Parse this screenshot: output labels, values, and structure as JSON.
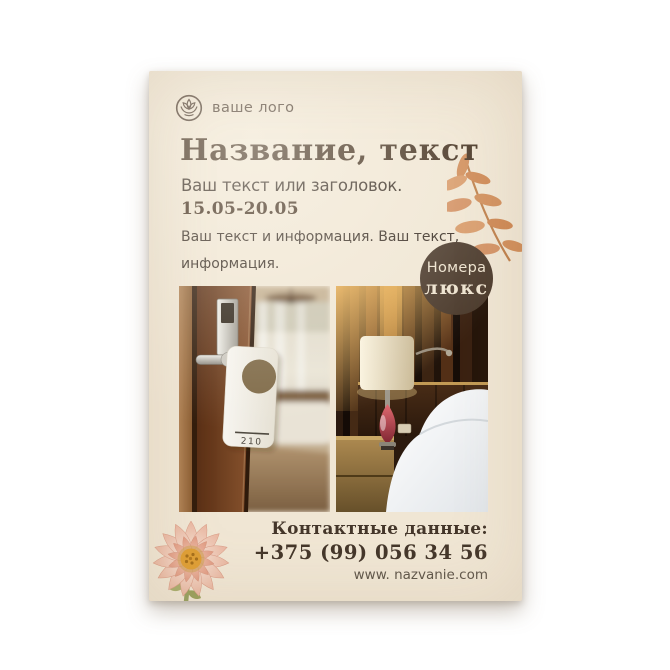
{
  "page": {
    "background": "#ffffff"
  },
  "flyer": {
    "background": "#f0e6d4",
    "logo": {
      "label": "ваше лого"
    },
    "title": "Название, текст",
    "subtitle": "Ваш текст или заголовок.",
    "dates": "15.05-20.05",
    "body": {
      "line1": "Ваш текст и информация. Ваш текст,",
      "line2": "информация."
    },
    "badge": {
      "line1": "Номера",
      "line2": "люкс",
      "background": "#4b3a2c",
      "text_color": "#eee3cf"
    },
    "photos": {
      "door_tag_number": "210"
    },
    "contacts": {
      "label": "Контактные данные:",
      "phone": "+375 (99) 056 34 56",
      "website": "www. nazvanie.com"
    },
    "colors": {
      "heading": "#43301f",
      "text": "#3a2f26",
      "muted": "#5f564a",
      "leaf": "#d08c58",
      "flower_petal": "#eec0ab"
    }
  }
}
